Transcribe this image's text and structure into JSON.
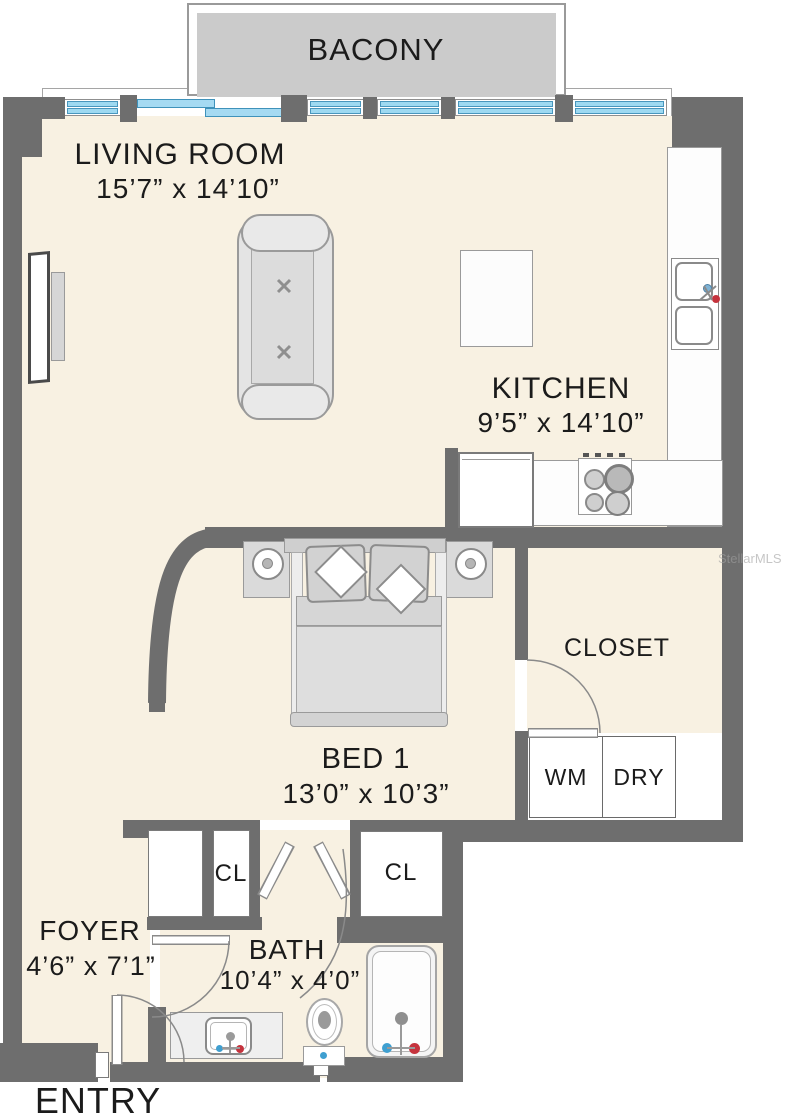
{
  "balcony": {
    "label": "BACONY"
  },
  "rooms": {
    "living": {
      "name": "LIVING ROOM",
      "dims": "15’7” x 14’10”"
    },
    "kitchen": {
      "name": "KITCHEN",
      "dims": "9’5” x 14’10”"
    },
    "bed1": {
      "name": "BED 1",
      "dims": "13’0” x 10’3”"
    },
    "closet": {
      "name": "CLOSET"
    },
    "foyer": {
      "name": "FOYER",
      "dims": "4’6” x 7’1”"
    },
    "bath": {
      "name": "BATH",
      "dims": "10’4” x 4’0”"
    },
    "closet_left": {
      "name": "CL"
    },
    "closet_right": {
      "name": "CL"
    },
    "washer": {
      "name": "WM"
    },
    "dryer": {
      "name": "DRY"
    }
  },
  "entry": {
    "label": "ENTRY"
  },
  "watermark": {
    "label": "StellarMLS"
  },
  "colors": {
    "wall": "#6e6e6e",
    "floor": "#f8f1e2",
    "balcony_floor": "#cbcbcb",
    "window_glass": "#9ed9f1",
    "hot_water": "#c5333d",
    "cold_water": "#3f9fd0"
  }
}
